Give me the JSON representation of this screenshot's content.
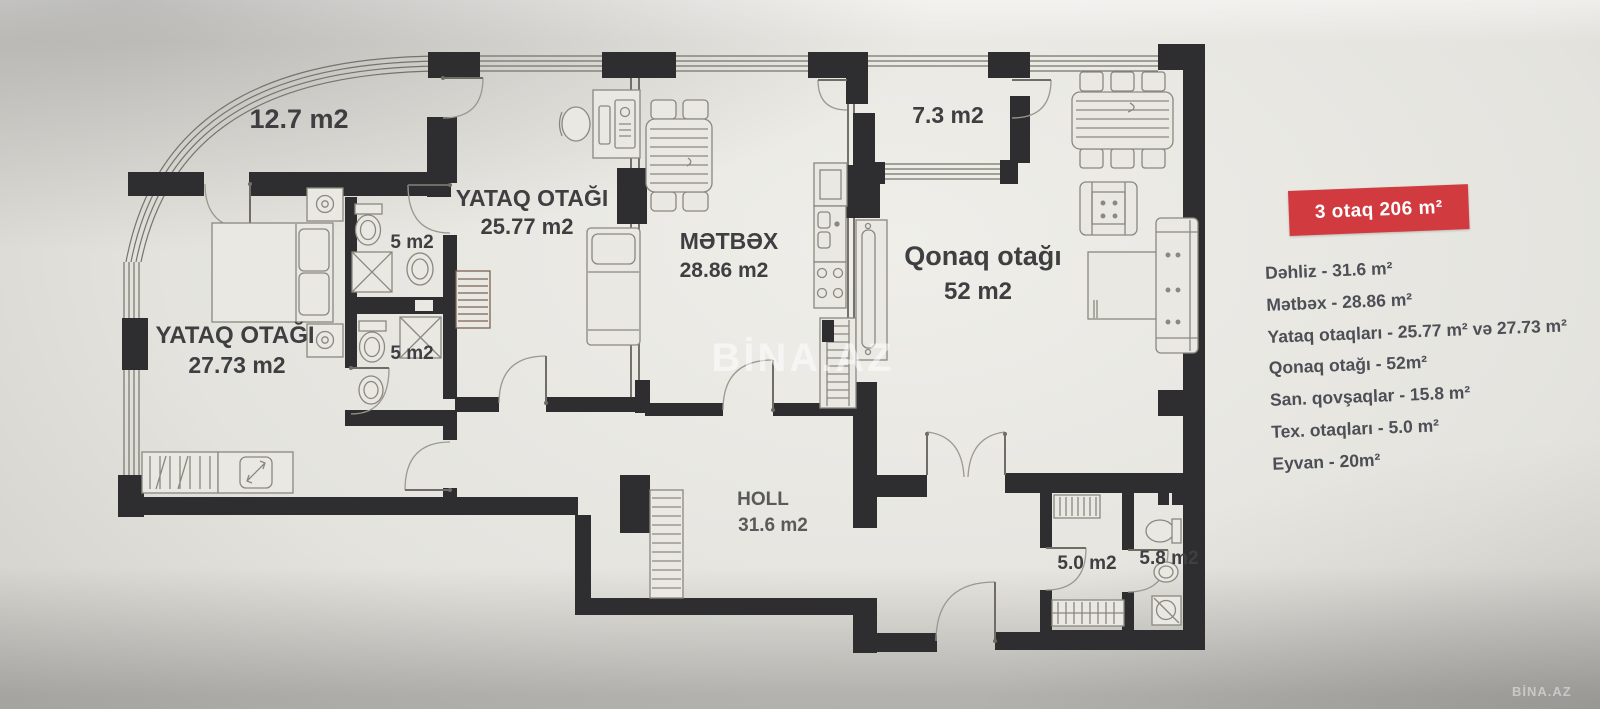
{
  "plan": {
    "rooms": {
      "eyvan_nw": {
        "area": "12.7 m2"
      },
      "bedroom_25": {
        "name": "YATAQ OTAĞI",
        "area": "25.77 m2"
      },
      "kitchen": {
        "name": "MƏTBƏX",
        "area": "28.86 m2"
      },
      "eyvan_n": {
        "area": "7.3 m2"
      },
      "living": {
        "name": "Qonaq otağı",
        "area": "52 m2"
      },
      "bedroom_27": {
        "name": "YATAQ OTAĞI",
        "area": "27.73 m2"
      },
      "bath_1": {
        "area": "5 m2"
      },
      "bath_2": {
        "area": "5 m2"
      },
      "hall": {
        "name": "HOLL",
        "area": "31.6 m2"
      },
      "tex_room": {
        "area": "5.0 m2"
      },
      "wc": {
        "area": "5.8 m2"
      }
    },
    "watermark_center": "BİNA.AZ",
    "watermark_corner": "BİNA.AZ"
  },
  "legend": {
    "badge_label": "3 otaq 206 m²",
    "items": [
      "Dəhliz - 31.6 m²",
      "Mətbəx - 28.86 m²",
      "Yataq otaqları - 25.77 m² və 27.73 m²",
      "Qonaq otağı - 52m²",
      "San. qovşaqlar - 15.8 m²",
      "Tex. otaqları - 5.0 m²",
      "Eyvan - 20m²"
    ]
  },
  "colors": {
    "badge_bg": "#d13b40",
    "wall": "#2e2e30",
    "label_text": "#3f3f42",
    "legend_text": "#4d4f56",
    "paper": "#e9e8e3"
  }
}
